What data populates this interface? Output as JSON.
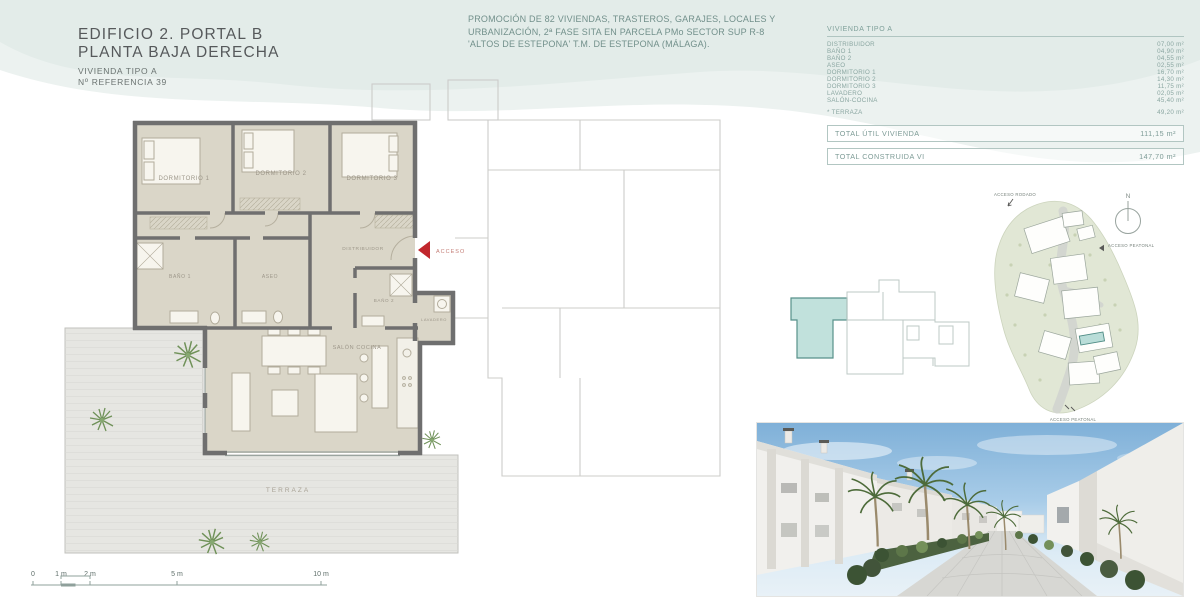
{
  "header": {
    "title_line1": "EDIFICIO 2. PORTAL B",
    "title_line2": "PLANTA BAJA DERECHA",
    "ref_line1": "VIVIENDA TIPO A",
    "ref_line2": "Nº REFERENCIA 39"
  },
  "promo": {
    "line1": "PROMOCIÓN DE 82 VIVIENDAS, TRASTEROS, GARAJES, LOCALES Y",
    "line2": "URBANIZACIÓN, 2ª FASE SITA EN PARCELA PMo SECTOR SUP R-8",
    "line3": "'ALTOS DE ESTEPONA' T.M. DE ESTEPONA (MÁLAGA)."
  },
  "areas": {
    "header": "VIVIENDA TIPO A",
    "rows": [
      {
        "label": "DISTRIBUIDOR",
        "value": "07,00 m²"
      },
      {
        "label": "BAÑO 1",
        "value": "04,90 m²"
      },
      {
        "label": "BAÑO 2",
        "value": "04,55 m²"
      },
      {
        "label": "ASEO",
        "value": "02,55 m²"
      },
      {
        "label": "DORMITORIO 1",
        "value": "16,70 m²"
      },
      {
        "label": "DORMITORIO 2",
        "value": "14,30 m²"
      },
      {
        "label": "DORMITORIO 3",
        "value": "11,75 m²"
      },
      {
        "label": "LAVADERO",
        "value": "02,05 m²"
      },
      {
        "label": "SALÓN-COCINA",
        "value": "45,40 m²"
      },
      {
        "label": "* TERRAZA",
        "value": "49,20 m²"
      }
    ],
    "totals": [
      {
        "label": "TOTAL ÚTIL VIVIENDA",
        "value": "111,15 m²"
      },
      {
        "label": "TOTAL CONSTRUIDA VI",
        "value": "147,70 m²"
      }
    ]
  },
  "plan": {
    "rooms": {
      "dormitorio1": "DORMITORIO 1",
      "dormitorio2": "DORMITORIO 2",
      "dormitorio3": "DORMITORIO 3",
      "bano1": "BAÑO 1",
      "bano2": "BAÑO 2",
      "aseo": "ASEO",
      "distribuidor": "DISTRIBUIDOR",
      "lavadero": "LAVADERO",
      "salon_cocina": "SALÓN COCINA",
      "terraza": "TERRAZA"
    },
    "acceso": "ACCESO",
    "scale": [
      "0",
      "1 m",
      "2 m",
      "5 m",
      "10 m"
    ]
  },
  "site": {
    "north": "N",
    "acceso_rodado": "ACCESO RODADO",
    "acceso_peatonal_top": "ACCESO PEATONAL",
    "acceso_peatonal_bottom": "ACCESO PEATONAL"
  },
  "colors": {
    "accent_red": "#c1272d",
    "highlight_teal": "#bfe0db",
    "wave_mint": "#e3ece9",
    "wall_gray": "#6f6f6f",
    "floor_beige": "#dad6c8"
  }
}
